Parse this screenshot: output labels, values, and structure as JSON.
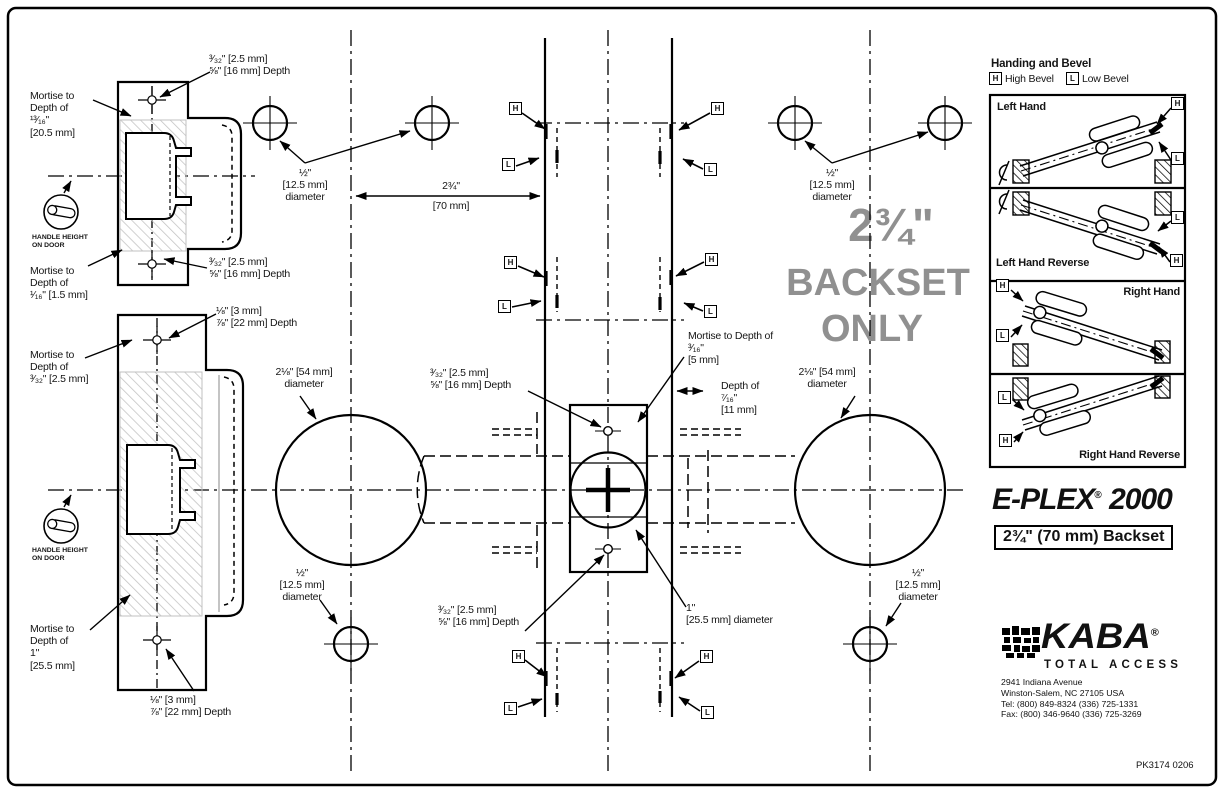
{
  "page": {
    "part_number": "PK3174 0206"
  },
  "watermark": {
    "size": "2¾\"",
    "line2": "BACKSET",
    "line3": "ONLY"
  },
  "hl": {
    "h": "H",
    "l": "L"
  },
  "icons": {
    "handle_height": "lever-handle-in-circle",
    "centerline": "C-with-slash-centerline-symbol",
    "kaba_symbol": "pixel-figure-logo",
    "screw_hole": "cross-in-circle",
    "bolt_hole": "crosshair-circle"
  },
  "shared": {
    "hole_332": "³⁄₃₂\" [2.5 mm]\n⅝\" [16 mm] Depth",
    "hole_18": "⅛\" [3 mm]\n⅞\" [22 mm] Depth",
    "half_dia": "½\"\n[12.5 mm]\ndiameter",
    "dia_218": "2⅛\" [54 mm]\ndiameter",
    "handle_height": "HANDLE HEIGHT\nON DOOR"
  },
  "mortise": {
    "m1": "Mortise to\nDepth of\n¹³⁄₁₆\"\n[20.5 mm]",
    "m2": "Mortise to\nDepth of\n¹⁄₁₆\" [1.5 mm]",
    "m3": "Mortise to\nDepth of\n³⁄₃₂\" [2.5 mm]",
    "m4": "Mortise to\nDepth of\n1\"\n[25.5 mm]",
    "m5": "Mortise to Depth of\n³⁄₁₆\"\n[5 mm]"
  },
  "dims": {
    "backset_in": "2¾\"",
    "backset_mm": "[70 mm]",
    "depth_716": "Depth of\n⁷⁄₁₆\"\n[11 mm]",
    "dia_1": "1\"\n[25.5 mm] diameter"
  },
  "handing": {
    "title": "Handing and Bevel",
    "high": "High Bevel",
    "low": "Low Bevel",
    "panels": [
      "Left Hand",
      "Left Hand Reverse",
      "Right Hand",
      "Right Hand Reverse"
    ]
  },
  "branding": {
    "product": "E-PLEX",
    "product_reg": "®",
    "product_num": " 2000",
    "backset_box": "2¾\" (70 mm) Backset",
    "kaba": "KABA",
    "kaba_reg": "®",
    "tagline": "TOTAL ACCESS",
    "address": "2941 Indiana Avenue\nWinston-Salem, NC 27105 USA\nTel: (800) 849-8324  (336) 725-1331\nFax: (800) 346-9640  (336) 725-3269"
  },
  "colors": {
    "line": "#000000",
    "hatch": "#c4c4c4",
    "watermark": "#909090"
  }
}
